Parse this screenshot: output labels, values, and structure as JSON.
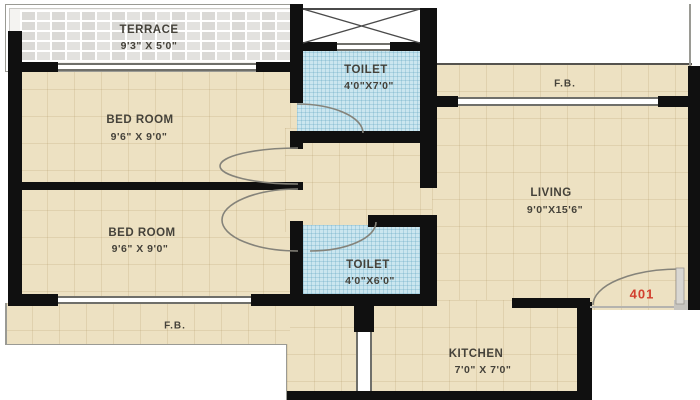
{
  "plan": {
    "type": "apartment-floor-plan",
    "unit": {
      "number": "401"
    },
    "rooms": {
      "terrace": {
        "name": "TERRACE",
        "dims": "9'3\" X 5'0\""
      },
      "bedroom1": {
        "name": "BED ROOM",
        "dims": "9'6\" X 9'0\""
      },
      "bedroom2": {
        "name": "BED ROOM",
        "dims": "9'6\" X 9'0\""
      },
      "toilet1": {
        "name": "TOILET",
        "dims": "4'0\"X7'0\""
      },
      "toilet2": {
        "name": "TOILET",
        "dims": "4'0\"X6'0\""
      },
      "living": {
        "name": "LIVING",
        "dims": "9'0\"X15'6\""
      },
      "kitchen": {
        "name": "KITCHEN",
        "dims": "7'0\" X 7'0\""
      },
      "fb_top": {
        "label": "F.B."
      },
      "fb_bottom": {
        "label": "F.B."
      }
    },
    "colors": {
      "floor_beige": "#EDE1C2",
      "toilet_tile_blue": "#CBE6EF",
      "terrace_gray": "#E3E2DF",
      "wall_black": "#101010",
      "unit_accent_red": "#D23F2E",
      "outside_white": "#FFFFFF"
    }
  }
}
